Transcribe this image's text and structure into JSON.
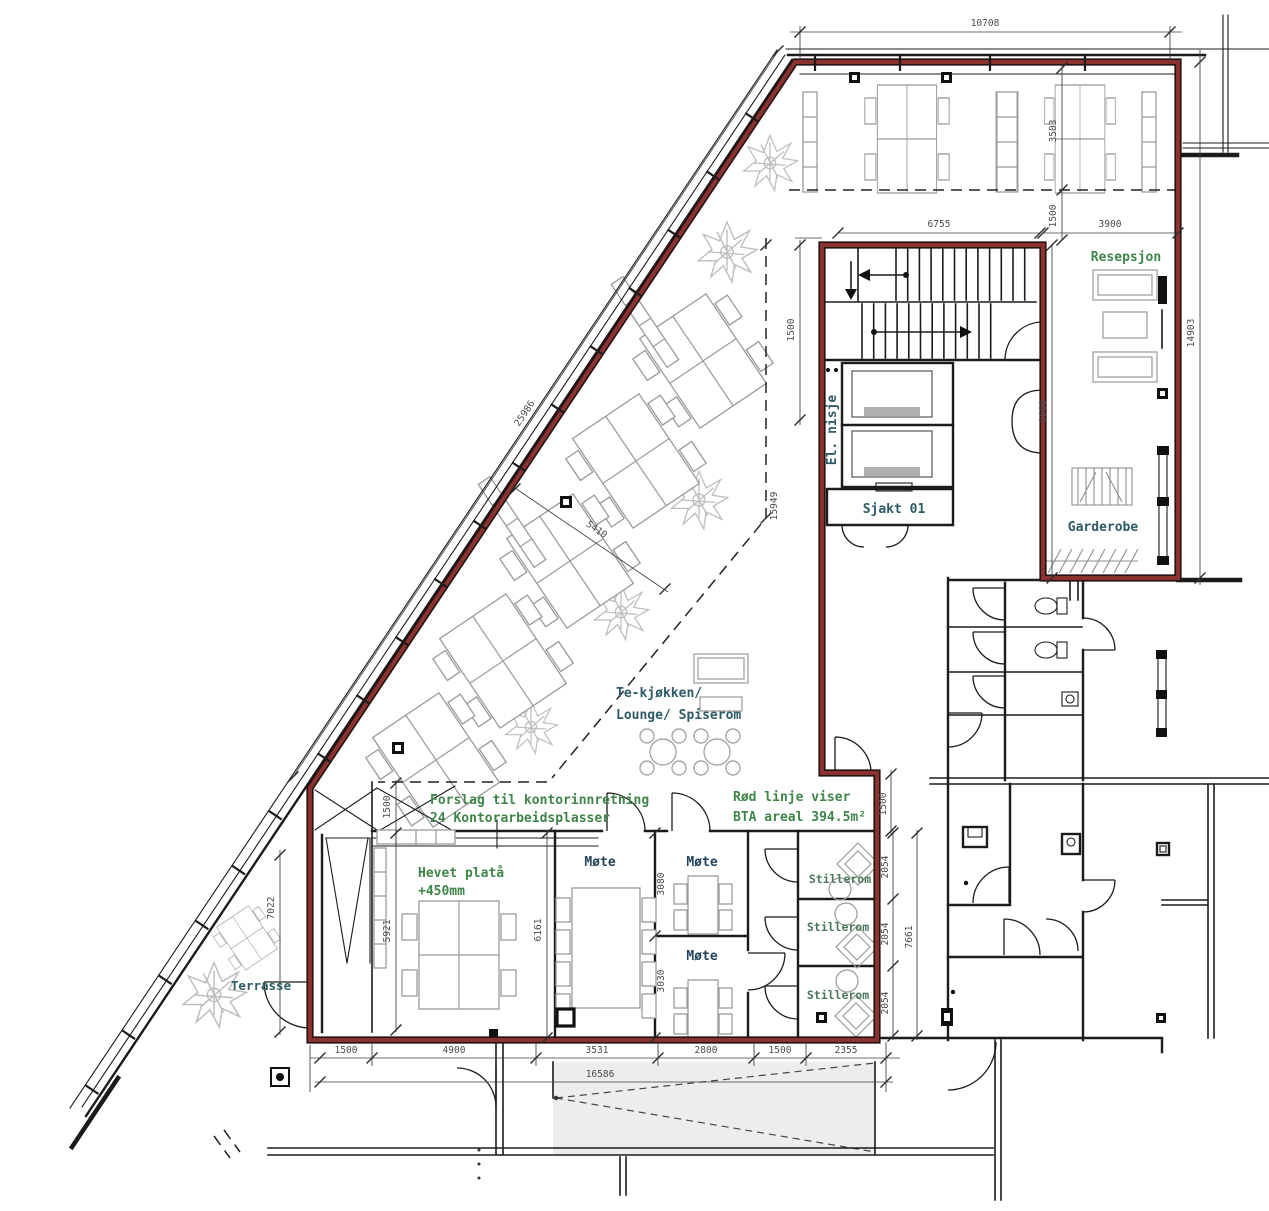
{
  "document": {
    "type": "architectural-floor-plan",
    "language": "Norwegian"
  },
  "labels": {
    "reception": "Resepsjon",
    "cloakroom": "Garderobe",
    "shaft": "Sjakt 01",
    "el_niche": "El. nisje",
    "kitchen1": "Te-kjøkken/",
    "kitchen2": "Lounge/ Spiserom",
    "proposal1": "Forslag til kontorinnretning",
    "proposal2": "24 Kontorarbeidsplasser",
    "redline1": "Rød linje viser",
    "redline2": "BTA areal 394.5m²",
    "platform1": "Hevet platå",
    "platform2": "+450mm",
    "meeting": "Møte",
    "quiet": "Stillerom",
    "terrace": "Terrasse"
  },
  "dims": {
    "d10708": "10708",
    "d3503": "3503",
    "d1500": "1500",
    "d6755": "6755",
    "d3900": "3900",
    "d9900": "9900",
    "d14903": "14903",
    "d15949": "15949",
    "d5410": "5410",
    "d25986": "25986",
    "d7022": "7022",
    "d5921": "5921",
    "d6161": "6161",
    "d3080": "3080",
    "d3030": "3030",
    "d2054": "2054",
    "d7661": "7661",
    "d4900": "4900",
    "d3531": "3531",
    "d2800": "2800",
    "d2355": "2355",
    "d16586": "16586"
  },
  "colors": {
    "bta_boundary_red": "#8a3230",
    "wall_black": "#1b1b1b",
    "furniture_gray": "#9a9a9a",
    "room_label_teal": "#2c5a66",
    "annotation_green": "#3f8549",
    "quiet_label_green": "#49795a",
    "meeting_label_dark": "#24455c",
    "dimension_text": "#4a4a4a",
    "ramp_fill": "#ededed"
  }
}
